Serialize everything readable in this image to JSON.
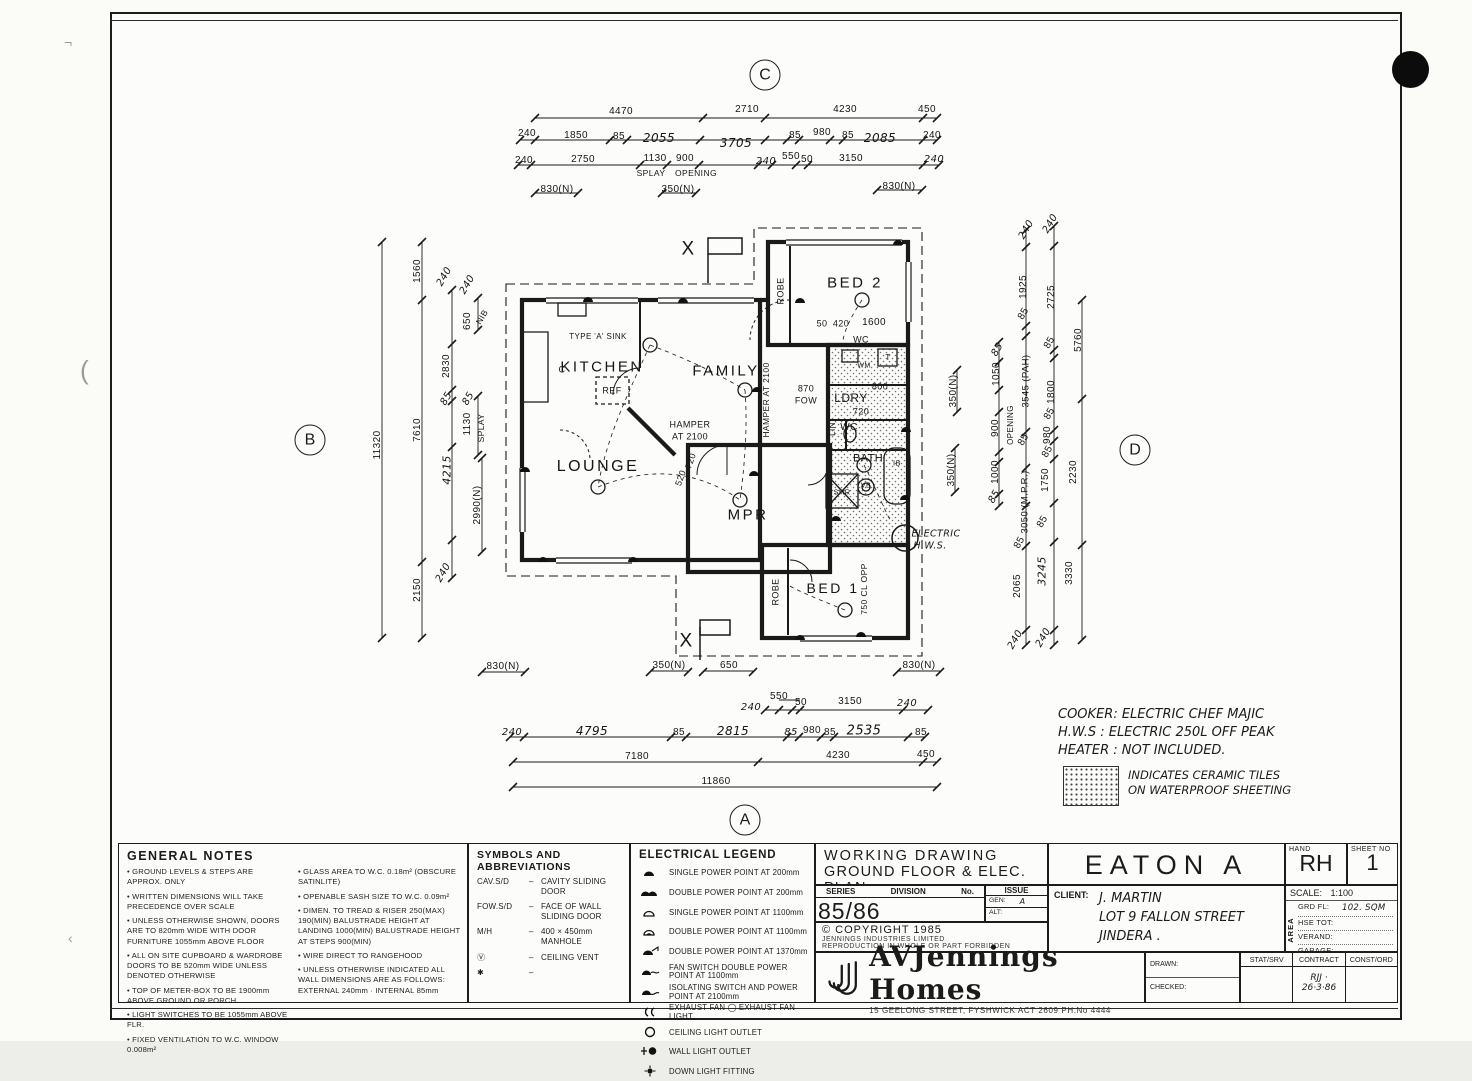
{
  "plan": {
    "labels": [
      {
        "t": "KITCHEN",
        "x": 602,
        "y": 367,
        "s": 15,
        "cls": "room"
      },
      {
        "t": "FAMILY",
        "x": 726,
        "y": 371,
        "s": 15,
        "cls": "room"
      },
      {
        "t": "LOUNGE",
        "x": 598,
        "y": 467,
        "s": 16,
        "cls": "room"
      },
      {
        "t": "MPR",
        "x": 748,
        "y": 515,
        "s": 15,
        "cls": "room"
      },
      {
        "t": "BED 2",
        "x": 855,
        "y": 283,
        "s": 15,
        "cls": "room"
      },
      {
        "t": "BED 1",
        "x": 833,
        "y": 588,
        "s": 14,
        "cls": "room"
      },
      {
        "t": "LDRY",
        "x": 851,
        "y": 398,
        "s": 12
      },
      {
        "t": "WC",
        "x": 861,
        "y": 340,
        "s": 9
      },
      {
        "t": "WC",
        "x": 849,
        "y": 428,
        "s": 10
      },
      {
        "t": "BATH",
        "x": 868,
        "y": 459,
        "s": 11
      },
      {
        "t": "SHR",
        "x": 842,
        "y": 492,
        "s": 7.5
      },
      {
        "t": "VB",
        "x": 866,
        "y": 486,
        "s": 7
      },
      {
        "t": "IB",
        "x": 897,
        "y": 463,
        "s": 7.5
      },
      {
        "t": "T",
        "x": 888,
        "y": 358,
        "s": 8
      },
      {
        "t": "WM",
        "x": 864,
        "y": 366,
        "s": 7
      },
      {
        "t": "REF",
        "x": 612,
        "y": 391,
        "s": 9
      },
      {
        "t": "TYPE 'A' SINK",
        "x": 598,
        "y": 337,
        "s": 8
      },
      {
        "t": "C",
        "x": 562,
        "y": 370,
        "s": 9
      },
      {
        "t": "ROBE",
        "x": 781,
        "y": 291,
        "r": -90,
        "s": 9
      },
      {
        "t": "ROBE",
        "x": 776,
        "y": 592,
        "r": -90,
        "s": 9
      },
      {
        "t": "LIN",
        "x": 833,
        "y": 429,
        "r": -90,
        "s": 8
      },
      {
        "t": "ELECTRIC",
        "x": 936,
        "y": 534,
        "s": 9.5,
        "cls": "hand"
      },
      {
        "t": "H.W.S.",
        "x": 930,
        "y": 546,
        "s": 9.5,
        "cls": "hand"
      },
      {
        "t": "X",
        "x": 688,
        "y": 249,
        "s": 19
      },
      {
        "t": "X",
        "x": 686,
        "y": 641,
        "s": 19
      },
      {
        "t": "HAMPER",
        "x": 690,
        "y": 425,
        "s": 9
      },
      {
        "t": "AT 2100",
        "x": 690,
        "y": 437,
        "s": 9
      },
      {
        "t": "HAMPER AT 2100",
        "x": 766,
        "y": 400,
        "r": -90,
        "s": 8.5
      },
      {
        "t": "870",
        "x": 806,
        "y": 389,
        "s": 9
      },
      {
        "t": "FOW",
        "x": 806,
        "y": 401,
        "s": 9
      },
      {
        "t": "50",
        "x": 822,
        "y": 324,
        "s": 9
      },
      {
        "t": "420",
        "x": 841,
        "y": 324,
        "s": 9
      },
      {
        "t": "1600",
        "x": 874,
        "y": 323,
        "s": 10
      },
      {
        "t": "800",
        "x": 880,
        "y": 387,
        "s": 9
      },
      {
        "t": "720",
        "x": 861,
        "y": 412,
        "s": 9
      },
      {
        "t": "520",
        "x": 681,
        "y": 478,
        "r": -70,
        "s": 9
      },
      {
        "t": "720",
        "x": 691,
        "y": 461,
        "r": -70,
        "s": 9
      },
      {
        "t": "750 CL OPP",
        "x": 864,
        "y": 589,
        "r": -90,
        "s": 8.5
      },
      {
        "t": "350(N)",
        "x": 954,
        "y": 391,
        "r": -90,
        "s": 10
      },
      {
        "t": "350(N)",
        "x": 952,
        "y": 470,
        "r": -90,
        "s": 10
      },
      {
        "t": "4470",
        "x": 621,
        "y": 112
      },
      {
        "t": "2710",
        "x": 747,
        "y": 110
      },
      {
        "t": "4230",
        "x": 845,
        "y": 110
      },
      {
        "t": "450",
        "x": 927,
        "y": 110
      },
      {
        "t": "240",
        "x": 527,
        "y": 134
      },
      {
        "t": "1850",
        "x": 576,
        "y": 136
      },
      {
        "t": "85",
        "x": 619,
        "y": 137
      },
      {
        "t": "2055",
        "x": 659,
        "y": 138,
        "s": 12,
        "cls": "hand"
      },
      {
        "t": "3705",
        "x": 736,
        "y": 143,
        "s": 12,
        "cls": "hand"
      },
      {
        "t": "85",
        "x": 795,
        "y": 136
      },
      {
        "t": "980",
        "x": 822,
        "y": 133
      },
      {
        "t": "85",
        "x": 848,
        "y": 136
      },
      {
        "t": "2085",
        "x": 880,
        "y": 138,
        "s": 12,
        "cls": "hand"
      },
      {
        "t": "240",
        "x": 932,
        "y": 136
      },
      {
        "t": "240",
        "x": 524,
        "y": 161
      },
      {
        "t": "2750",
        "x": 583,
        "y": 160
      },
      {
        "t": "1130",
        "x": 655,
        "y": 159
      },
      {
        "t": "900",
        "x": 685,
        "y": 159
      },
      {
        "t": "240",
        "x": 766,
        "y": 162,
        "cls": "hand"
      },
      {
        "t": "550",
        "x": 791,
        "y": 157
      },
      {
        "t": "50",
        "x": 807,
        "y": 160
      },
      {
        "t": "3150",
        "x": 851,
        "y": 159
      },
      {
        "t": "240",
        "x": 934,
        "y": 160,
        "cls": "hand"
      },
      {
        "t": "SPLAY",
        "x": 651,
        "y": 173,
        "s": 8.5
      },
      {
        "t": "OPENING",
        "x": 696,
        "y": 173,
        "s": 8.5
      },
      {
        "t": "830(N)",
        "x": 557,
        "y": 190
      },
      {
        "t": "350(N)",
        "x": 678,
        "y": 190
      },
      {
        "t": "830(N)",
        "x": 899,
        "y": 187
      },
      {
        "t": "830(N)",
        "x": 503,
        "y": 667
      },
      {
        "t": "350(N)",
        "x": 669,
        "y": 666
      },
      {
        "t": "650",
        "x": 729,
        "y": 666
      },
      {
        "t": "830(N)",
        "x": 919,
        "y": 666
      },
      {
        "t": "550",
        "x": 779,
        "y": 697
      },
      {
        "t": "240",
        "x": 751,
        "y": 708,
        "cls": "hand"
      },
      {
        "t": "50",
        "x": 801,
        "y": 703
      },
      {
        "t": "3150",
        "x": 850,
        "y": 702
      },
      {
        "t": "240",
        "x": 907,
        "y": 704,
        "cls": "hand"
      },
      {
        "t": "240",
        "x": 512,
        "y": 733,
        "cls": "hand"
      },
      {
        "t": "4795",
        "x": 592,
        "y": 731,
        "s": 12,
        "cls": "hand"
      },
      {
        "t": "85",
        "x": 679,
        "y": 733
      },
      {
        "t": "2815",
        "x": 733,
        "y": 731,
        "s": 12,
        "cls": "hand"
      },
      {
        "t": "85",
        "x": 791,
        "y": 733,
        "cls": "hand"
      },
      {
        "t": "980",
        "x": 812,
        "y": 731
      },
      {
        "t": "85",
        "x": 830,
        "y": 733
      },
      {
        "t": "2535",
        "x": 864,
        "y": 731,
        "s": 13,
        "cls": "hand"
      },
      {
        "t": "85",
        "x": 921,
        "y": 733
      },
      {
        "t": "7180",
        "x": 637,
        "y": 757
      },
      {
        "t": "4230",
        "x": 838,
        "y": 756
      },
      {
        "t": "450",
        "x": 926,
        "y": 755
      },
      {
        "t": "11860",
        "x": 716,
        "y": 782
      },
      {
        "t": "11320",
        "x": 378,
        "y": 445,
        "r": -90
      },
      {
        "t": "1560",
        "x": 418,
        "y": 271,
        "r": -90
      },
      {
        "t": "7610",
        "x": 418,
        "y": 430,
        "r": -90
      },
      {
        "t": "2150",
        "x": 418,
        "y": 590,
        "r": -90
      },
      {
        "t": "240",
        "x": 445,
        "y": 277,
        "r": -60,
        "cls": "hand"
      },
      {
        "t": "240",
        "x": 468,
        "y": 285,
        "r": -60,
        "cls": "hand"
      },
      {
        "t": "650",
        "x": 468,
        "y": 321,
        "r": -90
      },
      {
        "t": "NIB",
        "x": 482,
        "y": 317,
        "r": -60,
        "s": 8.5
      },
      {
        "t": "2830",
        "x": 447,
        "y": 366,
        "r": -90
      },
      {
        "t": "85",
        "x": 447,
        "y": 399,
        "r": -60,
        "cls": "hand"
      },
      {
        "t": "85",
        "x": 469,
        "y": 399,
        "r": -60,
        "cls": "hand"
      },
      {
        "t": "1130",
        "x": 468,
        "y": 424,
        "r": -90
      },
      {
        "t": "SPLAY",
        "x": 481,
        "y": 428,
        "r": -90,
        "s": 8.5
      },
      {
        "t": "4215",
        "x": 447,
        "y": 470,
        "r": -90,
        "s": 11,
        "cls": "hand"
      },
      {
        "t": "240",
        "x": 444,
        "y": 573,
        "r": -60,
        "cls": "hand"
      },
      {
        "t": "2990(N)",
        "x": 478,
        "y": 505,
        "r": -90
      },
      {
        "t": "240",
        "x": 1027,
        "y": 230,
        "r": -60,
        "cls": "hand"
      },
      {
        "t": "240",
        "x": 1051,
        "y": 224,
        "r": -60,
        "cls": "hand"
      },
      {
        "t": "1925",
        "x": 1024,
        "y": 287,
        "r": -90
      },
      {
        "t": "85",
        "x": 1024,
        "y": 314,
        "r": -60
      },
      {
        "t": "3545 (PAH)",
        "x": 1026,
        "y": 381,
        "r": -90,
        "s": 9.5
      },
      {
        "t": "85",
        "x": 998,
        "y": 350,
        "r": -60,
        "cls": "hand"
      },
      {
        "t": "1050",
        "x": 997,
        "y": 374,
        "r": -90
      },
      {
        "t": "900",
        "x": 996,
        "y": 428,
        "r": -90
      },
      {
        "t": "OPENING",
        "x": 1011,
        "y": 425,
        "r": -90,
        "s": 8
      },
      {
        "t": "1000",
        "x": 996,
        "y": 472,
        "r": -90
      },
      {
        "t": "85",
        "x": 995,
        "y": 497,
        "r": -60,
        "cls": "hand"
      },
      {
        "t": "85",
        "x": 1024,
        "y": 440,
        "r": -60
      },
      {
        "t": "3050 (M.P.R.)",
        "x": 1025,
        "y": 502,
        "r": -90,
        "s": 9.5
      },
      {
        "t": "85",
        "x": 1020,
        "y": 543,
        "r": -60
      },
      {
        "t": "2065",
        "x": 1018,
        "y": 586,
        "r": -90
      },
      {
        "t": "240",
        "x": 1016,
        "y": 640,
        "r": -60,
        "cls": "hand"
      },
      {
        "t": "2725",
        "x": 1052,
        "y": 297,
        "r": -90
      },
      {
        "t": "85",
        "x": 1050,
        "y": 343,
        "r": -60
      },
      {
        "t": "1800",
        "x": 1052,
        "y": 392,
        "r": -90
      },
      {
        "t": "85",
        "x": 1050,
        "y": 414,
        "r": -60
      },
      {
        "t": "980",
        "x": 1048,
        "y": 435,
        "r": -90
      },
      {
        "t": "85",
        "x": 1048,
        "y": 452,
        "r": -60
      },
      {
        "t": "1750",
        "x": 1046,
        "y": 480,
        "r": -90
      },
      {
        "t": "85",
        "x": 1043,
        "y": 522,
        "r": -60
      },
      {
        "t": "3245",
        "x": 1042,
        "y": 571,
        "r": -90,
        "s": 11,
        "cls": "hand"
      },
      {
        "t": "240",
        "x": 1044,
        "y": 638,
        "r": -60,
        "cls": "hand"
      },
      {
        "t": "5760",
        "x": 1079,
        "y": 340,
        "r": -90
      },
      {
        "t": "2230",
        "x": 1074,
        "y": 472,
        "r": -90
      },
      {
        "t": "3330",
        "x": 1070,
        "y": 573,
        "r": -90
      }
    ],
    "section_markers": [
      {
        "t": "C",
        "x": 765,
        "y": 75
      },
      {
        "t": "B",
        "x": 310,
        "y": 440
      },
      {
        "t": "D",
        "x": 1135,
        "y": 450
      },
      {
        "t": "A",
        "x": 745,
        "y": 820
      }
    ]
  },
  "side_notes": {
    "cooker": "COOKER: ELECTRIC CHEF MAJIC",
    "hws": "H.W.S : ELECTRIC 250L OFF PEAK",
    "heater": "HEATER : NOT INCLUDED.",
    "tiles_line1": "INDICATES CERAMIC TILES",
    "tiles_line2": "ON WATERPROOF SHEETING"
  },
  "general_notes": {
    "title": "GENERAL NOTES",
    "left": [
      "GROUND LEVELS & STEPS ARE APPROX. ONLY",
      "WRITTEN DIMENSIONS WILL TAKE PRECEDENCE OVER SCALE",
      "UNLESS OTHERWISE SHOWN, DOORS ARE TO 820mm WIDE WITH DOOR FURNITURE 1055mm ABOVE FLOOR",
      "ALL ON SITE CUPBOARD & WARDROBE DOORS TO BE 520mm WIDE UNLESS DENOTED OTHERWISE",
      "TOP OF METER-BOX TO BE 1900mm ABOVE GROUND OR PORCH",
      "LIGHT SWITCHES TO BE 1055mm ABOVE FLR.",
      "FIXED VENTILATION TO W.C. WINDOW 0.008m²"
    ],
    "right": [
      "GLASS AREA TO W.C. 0.18m² (OBSCURE SATINLITE)",
      "OPENABLE SASH SIZE TO W.C. 0.09m²",
      "DIMEN. TO TREAD & RISER 250(MAX) 190(MIN) BALUSTRADE HEIGHT AT LANDING 1000(MIN) BALUSTRADE HEIGHT AT STEPS 900(MIN)",
      "WIRE DIRECT TO RANGEHOOD",
      "UNLESS OTHERWISE INDICATED ALL WALL DIMENSIONS ARE AS FOLLOWS: EXTERNAL 240mm · INTERNAL 85mm"
    ]
  },
  "symbols": {
    "title": "SYMBOLS AND ABBREVIATIONS",
    "items": [
      {
        "abbr": "CAV.S/D",
        "desc": "CAVITY SLIDING DOOR"
      },
      {
        "abbr": "FOW.S/D",
        "desc": "FACE OF WALL SLIDING DOOR"
      },
      {
        "abbr": "M/H",
        "desc": "400 × 450mm MANHOLE"
      },
      {
        "abbr": "Ⓥ",
        "desc": "CEILING VENT"
      },
      {
        "abbr": "✱",
        "desc": ""
      }
    ]
  },
  "electrical": {
    "title": "ELECTRICAL LEGEND",
    "items": [
      {
        "icon": "pp1-200",
        "desc": "SINGLE POWER POINT AT 200mm"
      },
      {
        "icon": "pp2-200",
        "desc": "DOUBLE POWER POINT AT 200mm"
      },
      {
        "icon": "pp1-1100",
        "desc": "SINGLE POWER POINT AT 1100mm"
      },
      {
        "icon": "pp2-1100",
        "desc": "DOUBLE POWER POINT AT 1100mm"
      },
      {
        "icon": "pp2-1370",
        "desc": "DOUBLE POWER POINT AT 1370mm"
      },
      {
        "icon": "fan-pp2",
        "desc": "FAN SWITCH DOUBLE POWER POINT AT 1100mm"
      },
      {
        "icon": "iso-pp",
        "desc": "ISOLATING SWITCH AND POWER POINT AT 2100mm"
      },
      {
        "icon": "exhaust",
        "desc": "EXHAUST FAN   ◯   EXHAUST FAN LIGHT"
      },
      {
        "icon": "ceiling-light",
        "desc": "CEILING LIGHT OUTLET"
      },
      {
        "icon": "wall-light",
        "desc": "WALL LIGHT OUTLET"
      },
      {
        "icon": "down-light",
        "desc": "DOWN LIGHT FITTING"
      }
    ]
  },
  "title_block": {
    "drawing_title_line1": "WORKING DRAWING",
    "drawing_title_line2": "GROUND FLOOR & ELEC. PLAN",
    "series_label": "SERIES",
    "division_label": "DIVISION",
    "no_label": "No.",
    "series_value": "85/86 A.C.T.370",
    "issue_label": "ISSUE",
    "gen_label": "GEN:",
    "gen_value": "A",
    "alt_label": "ALT:",
    "alt_value": "",
    "copyright": "© COPYRIGHT 1985",
    "company": "JENNINGS INDUSTRIES LIMITED",
    "forbidden": "REPRODUCTION IN WHOLE OR PART FORBIDDEN",
    "model": "EATON A",
    "client_label": "CLIENT:",
    "client_name": "J. MARTIN",
    "client_addr1": "LOT 9  FALLON  STREET",
    "client_addr2": "JINDERA .",
    "hand_label": "HAND",
    "hand_value": "RH",
    "sheet_label": "SHEET NO",
    "sheet_value": "1",
    "scale_label": "SCALE:",
    "scale_value": "1:100",
    "area_label": "AREA",
    "area_rows": [
      {
        "label": "GRD FL:",
        "value": "102. SQM"
      },
      {
        "label": "HSE TOT:",
        "value": ""
      },
      {
        "label": "VERAND:",
        "value": ""
      },
      {
        "label": "GARAGE:",
        "value": ""
      }
    ],
    "logo_text": "AVJennings Homes",
    "address": "15 GEELONG STREET, FYSHWICK ACT 2609 PH.No 4444",
    "drawn_label": "DRAWN:",
    "checked_label": "CHECKED:",
    "stat_cols": [
      "STAT/SRV",
      "CONTRACT",
      "CONST/ORD"
    ],
    "stat_values": [
      "",
      "RJJ · 26·3·86",
      ""
    ]
  }
}
